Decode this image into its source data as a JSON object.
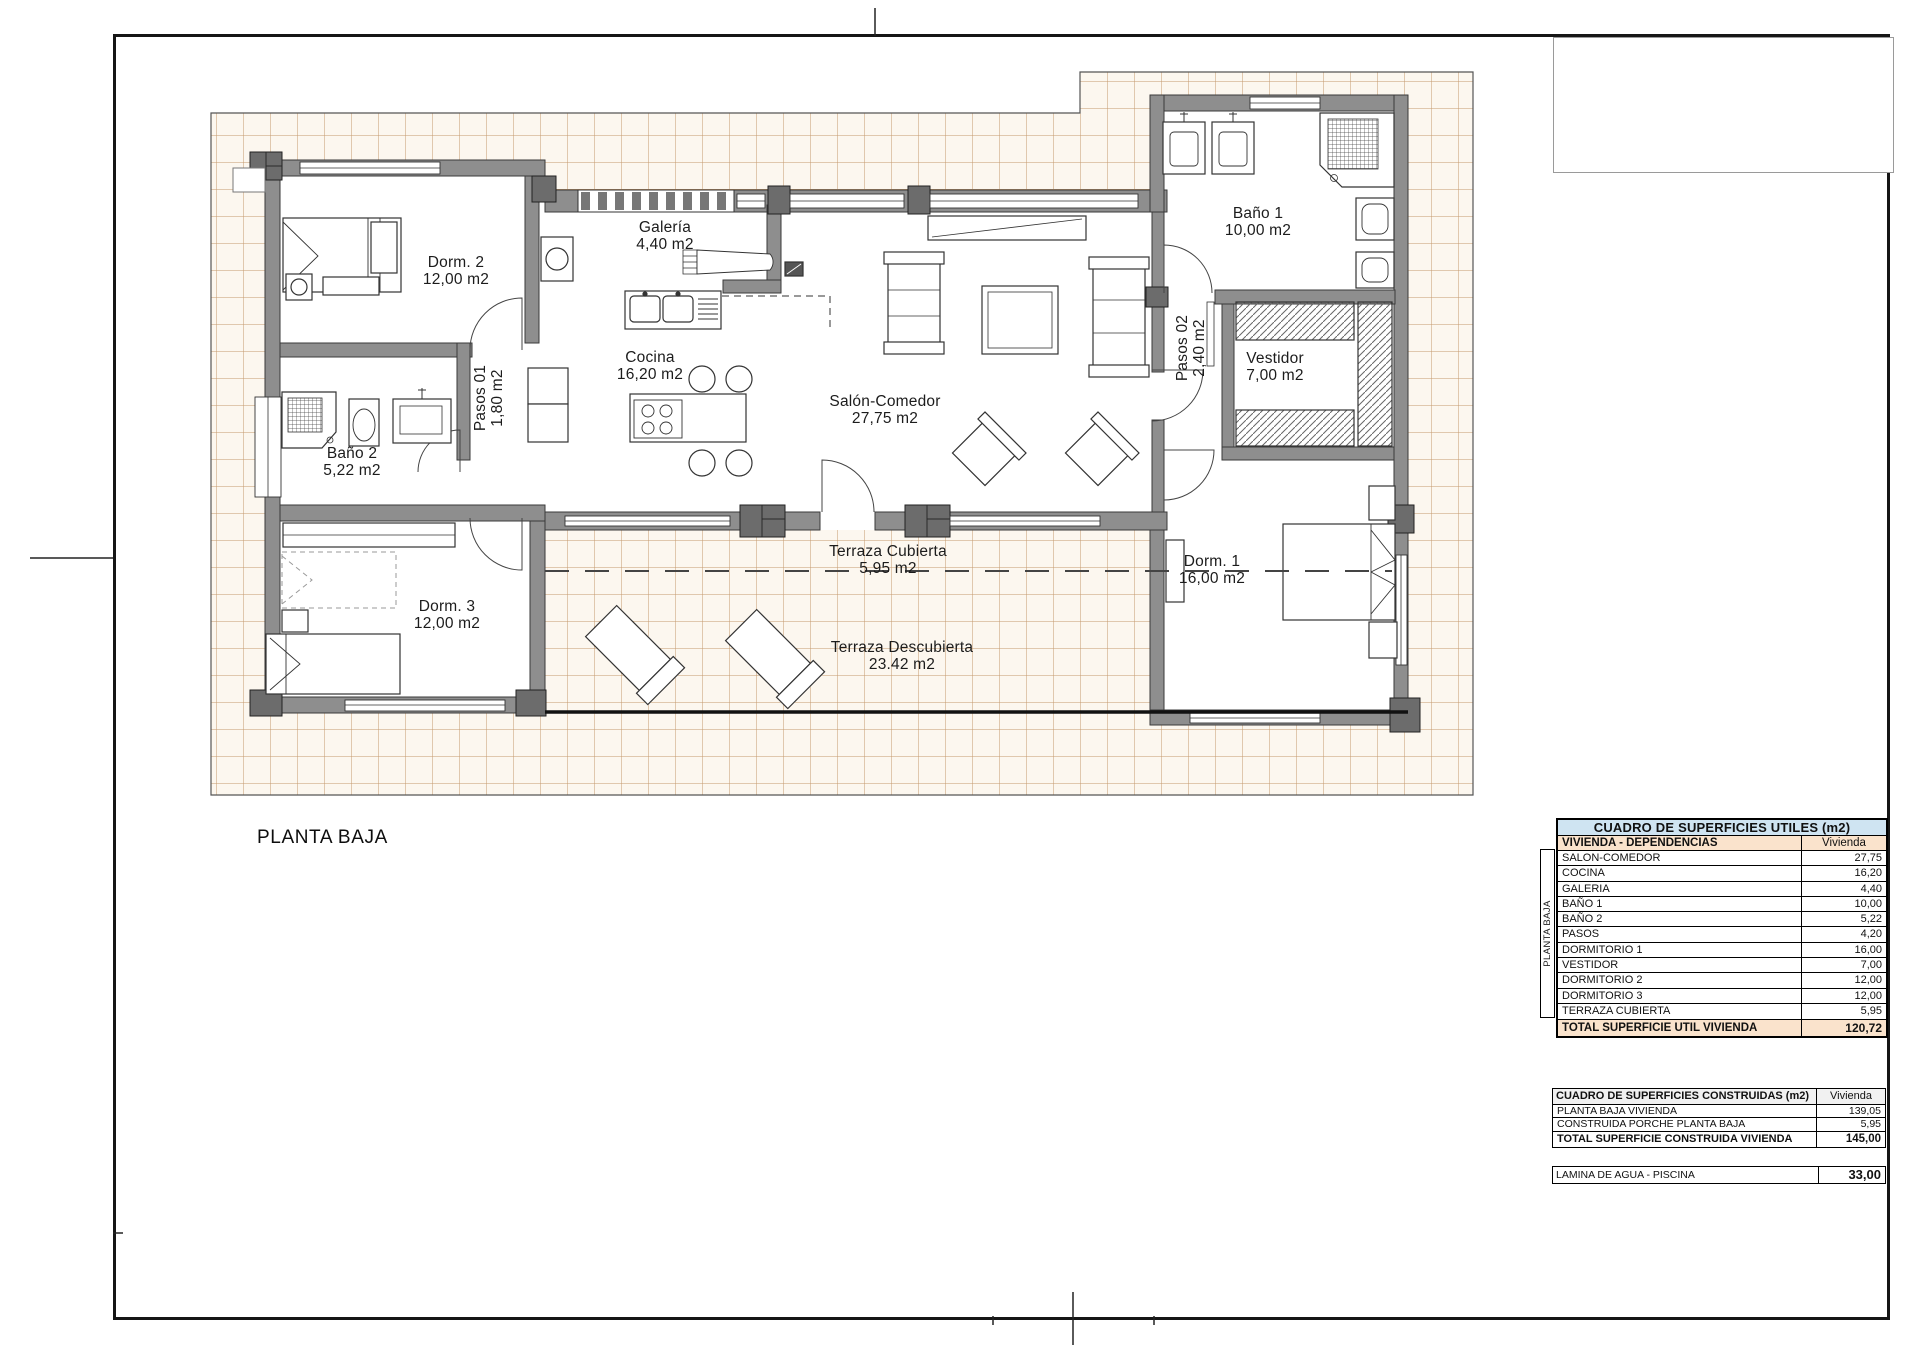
{
  "page": {
    "plan_title": "PLANTA BAJA"
  },
  "plan": {
    "rooms": {
      "dorm2": {
        "name": "Dorm. 2",
        "area": "12,00 m2"
      },
      "galeria": {
        "name": "Galería",
        "area": "4,40 m2"
      },
      "bano1": {
        "name": "Baño 1",
        "area": "10,00 m2"
      },
      "cocina": {
        "name": "Cocina",
        "area": "16,20 m2"
      },
      "salon": {
        "name": "Salón-Comedor",
        "area": "27,75 m2"
      },
      "pasos01": {
        "name": "Pasos 01",
        "area": "1,80 m2"
      },
      "pasos02": {
        "name": "Pasos 02",
        "area": "2,40 m2"
      },
      "vestidor": {
        "name": "Vestidor",
        "area": "7,00 m2"
      },
      "bano2": {
        "name": "Baño 2",
        "area": "5,22 m2"
      },
      "dorm3": {
        "name": "Dorm. 3",
        "area": "12,00 m2"
      },
      "dorm1": {
        "name": "Dorm. 1",
        "area": "16,00 m2"
      },
      "terraza_c": {
        "name": "Terraza Cubierta",
        "area": "5,95 m2"
      },
      "terraza_d": {
        "name": "Terraza Descubierta",
        "area": "23.42 m2"
      }
    }
  },
  "tables": {
    "utiles": {
      "title": "CUADRO DE SUPERFICIES UTILES (m2)",
      "header_left": "VIVIENDA - DEPENDENCIAS",
      "header_right": "Vivienda",
      "side_label": "PLANTA BAJA",
      "rows": [
        [
          "SALON-COMEDOR",
          "27,75"
        ],
        [
          "COCINA",
          "16,20"
        ],
        [
          "GALERIA",
          "4,40"
        ],
        [
          "BAÑO 1",
          "10,00"
        ],
        [
          "BAÑO 2",
          "5,22"
        ],
        [
          "PASOS",
          "4,20"
        ],
        [
          "DORMITORIO 1",
          "16,00"
        ],
        [
          "VESTIDOR",
          "7,00"
        ],
        [
          "DORMITORIO 2",
          "12,00"
        ],
        [
          "DORMITORIO 3",
          "12,00"
        ],
        [
          "TERRAZA CUBIERTA",
          "5,95"
        ]
      ],
      "total_label": "TOTAL SUPERFICIE UTIL VIVIENDA",
      "total_value": "120,72"
    },
    "construidas": {
      "title": "CUADRO DE SUPERFICIES CONSTRUIDAS (m2)",
      "header_right": "Vivienda",
      "rows": [
        [
          "PLANTA BAJA VIVIENDA",
          "139,05"
        ],
        [
          "CONSTRUIDA PORCHE PLANTA BAJA",
          "5,95"
        ]
      ],
      "total_label": "TOTAL SUPERFICIE CONSTRUIDA VIVIENDA",
      "total_value": "145,00"
    },
    "piscina": {
      "label": "LAMINA DE AGUA - PISCINA",
      "value": "33,00"
    }
  },
  "colors": {
    "table_title_bg": "#CFE4F2",
    "table_header_bg": "#FAE3CC",
    "tile_line": "#C49A6E",
    "wall_fill": "#8E8E8E"
  }
}
